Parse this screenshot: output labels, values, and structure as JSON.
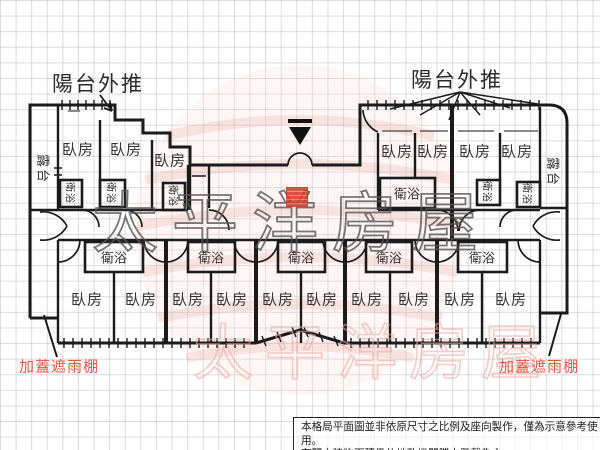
{
  "plan": {
    "labels": {
      "balcony_push_left": "陽台外推",
      "balcony_push_right": "陽台外推",
      "terrace_left": "露台",
      "terrace_right": "露台",
      "rain_shelter_left": "加蓋遮雨棚",
      "rain_shelter_right": "加蓋遮雨棚"
    },
    "rooms": {
      "top_left_bedrooms": [
        "臥房",
        "臥房",
        "臥房"
      ],
      "top_right_bedrooms": [
        "臥房",
        "臥房",
        "臥房",
        "臥房"
      ],
      "bottom_bedrooms": [
        "臥房",
        "臥房",
        "臥房",
        "臥房",
        "臥房",
        "臥房",
        "臥房",
        "臥房",
        "臥房",
        "臥房"
      ],
      "top_left_baths": [
        "衛浴",
        "衛浴",
        "衛浴"
      ],
      "top_right_baths": [
        "衛浴",
        "衛浴",
        "衛浴"
      ],
      "bottom_baths": [
        "衛浴",
        "衛浴",
        "衛浴",
        "衛浴",
        "衛浴"
      ]
    },
    "colors": {
      "wall": "#1b1b1b",
      "red_label": "#e85745",
      "grid": "#bebebe"
    }
  },
  "watermark": {
    "brand_text": "太平洋房屋",
    "gray_stroke": "#555555",
    "pink_stroke": "#ecaaa4",
    "ring_pink": "#eec3bf"
  },
  "disclaimer": {
    "line1": "本格局平面圖並非依原尺寸之比例及座向製作，僅為示意參考使用。",
    "line2": "有關之建物面積仍依地政機關謄本登載為主。"
  }
}
